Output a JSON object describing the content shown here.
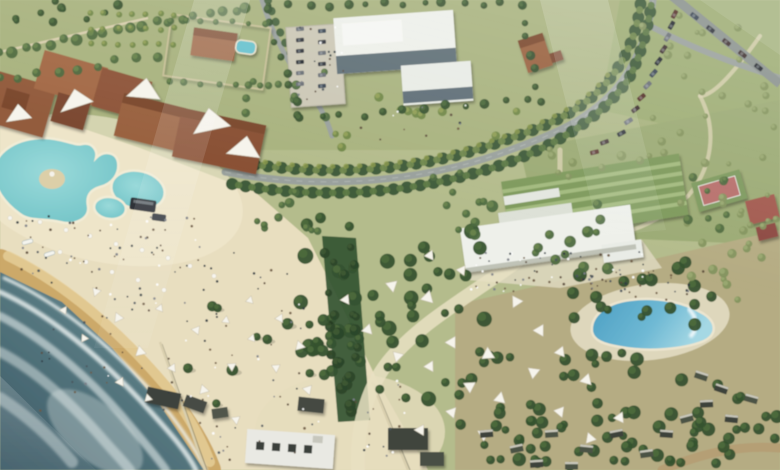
{
  "meta": {
    "title": "Aerial architectural rendering of a coastal beach resort masterplan",
    "image_type": "rendering",
    "text_visible": ""
  },
  "palette": {
    "sea_deep": "#3d5a66",
    "sea_shallow": "#7e9aa0",
    "foam": "#eef4f2",
    "sand": "#e8debf",
    "wet_sand": "#c9a35f",
    "park_green": "#b4bc8c",
    "lawn": "#9fae76",
    "road": "#9aa19d",
    "terracotta": "#9a6242",
    "white_building": "#eef0ea",
    "glass": "#50606a",
    "lagoon_pool": "#6cc0c4",
    "wave_pool": "#4c9fc3",
    "canopy_white": "#f6f4ec",
    "palm_dark": "#36522f",
    "palm_darkest": "#2c462a",
    "palm_mid": "#4e6a40",
    "palm_light": "#6f8747",
    "shrub_olive": "#84935e",
    "car_dark": "#30363c",
    "watermark": "#ffffff"
  },
  "scene": {
    "features": [
      {
        "id": "sea",
        "label": "sea with surf along bottom-left shoreline"
      },
      {
        "id": "beach",
        "label": "sand beach with umbrellas, tents and visitors"
      },
      {
        "id": "lagoon-pool",
        "label": "freeform lagoon swimming pool with island"
      },
      {
        "id": "wave-pool",
        "label": "blue wave pool on the right"
      },
      {
        "id": "resort-buildings",
        "label": "terracotta resort building cluster with white shade sails"
      },
      {
        "id": "modern-building",
        "label": "white modern building with glass facade and parking lot"
      },
      {
        "id": "amphitheater",
        "label": "white venue building with terraced green seating"
      },
      {
        "id": "tennis-court",
        "label": "red sports court at upper right"
      },
      {
        "id": "main-road",
        "label": "palm-lined curving boulevard"
      },
      {
        "id": "palm-groves",
        "label": "dense palm groves across center and lower right"
      },
      {
        "id": "watermark",
        "label": "translucent diagonal watermark shapes"
      }
    ]
  }
}
